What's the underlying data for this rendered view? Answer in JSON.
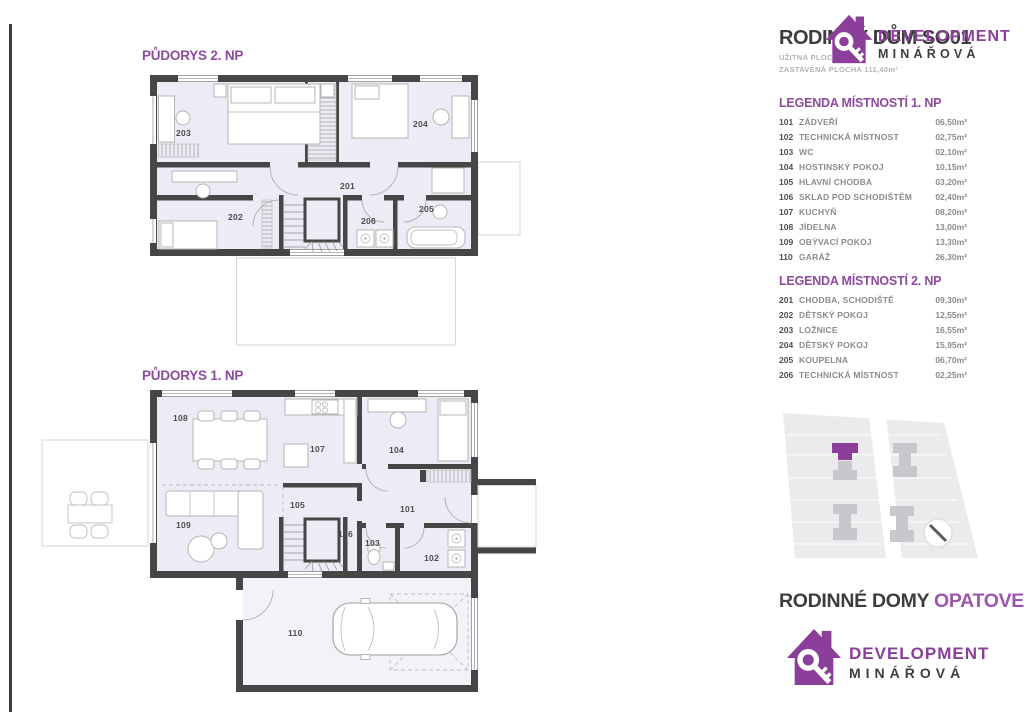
{
  "accent_color": "#8e3f9e",
  "header": {
    "title": "RODINNÝ DŮM SO01",
    "subtitle_line1": "UŽITNÁ PLOCHA",
    "subtitle_line2": "ZASTAVĚNÁ PLOCHA 111,40m²"
  },
  "brand": {
    "line1": "DEVELOPMENT",
    "line2": "MINÁŘOVÁ"
  },
  "plan2": {
    "title": "PŮDORYS 2. NP"
  },
  "plan1": {
    "title": "PŮDORYS 1. NP"
  },
  "legend_np1": {
    "heading": "LEGENDA MÍSTNOSTÍ 1. NP",
    "rows": [
      {
        "num": "101",
        "name": "ZÁDVEŘÍ",
        "area": "06,50m²"
      },
      {
        "num": "102",
        "name": "TECHNICKÁ MÍSTNOST",
        "area": "02,75m²"
      },
      {
        "num": "103",
        "name": "WC",
        "area": "02,10m²"
      },
      {
        "num": "104",
        "name": "HOSTINSKÝ POKOJ",
        "area": "10,15m²"
      },
      {
        "num": "105",
        "name": "HLAVNÍ CHODBA",
        "area": "03,20m²"
      },
      {
        "num": "106",
        "name": "SKLAD POD SCHODIŠTĚM",
        "area": "02,40m²"
      },
      {
        "num": "107",
        "name": "KUCHYŇ",
        "area": "08,20m²"
      },
      {
        "num": "108",
        "name": "JÍDELNA",
        "area": "13,00m²"
      },
      {
        "num": "109",
        "name": "OBÝVACÍ POKOJ",
        "area": "13,30m²"
      },
      {
        "num": "110",
        "name": "GARÁŽ",
        "area": "26,30m²"
      }
    ]
  },
  "legend_np2": {
    "heading": "LEGENDA MÍSTNOSTÍ 2. NP",
    "rows": [
      {
        "num": "201",
        "name": "CHODBA, SCHODIŠTĚ",
        "area": "09,30m²"
      },
      {
        "num": "202",
        "name": "DĚTSKÝ POKOJ",
        "area": "12,55m²"
      },
      {
        "num": "203",
        "name": "LOŽNICE",
        "area": "16,55m²"
      },
      {
        "num": "204",
        "name": "DĚTSKÝ POKOJ",
        "area": "15,95m²"
      },
      {
        "num": "205",
        "name": "KOUPELNA",
        "area": "06,70m²"
      },
      {
        "num": "206",
        "name": "TECHNICKÁ MÍSTNOST",
        "area": "02,25m²"
      }
    ]
  },
  "footer": {
    "title_dark": "RODINNÉ DOMY ",
    "title_accent": "OPATOVEC"
  }
}
